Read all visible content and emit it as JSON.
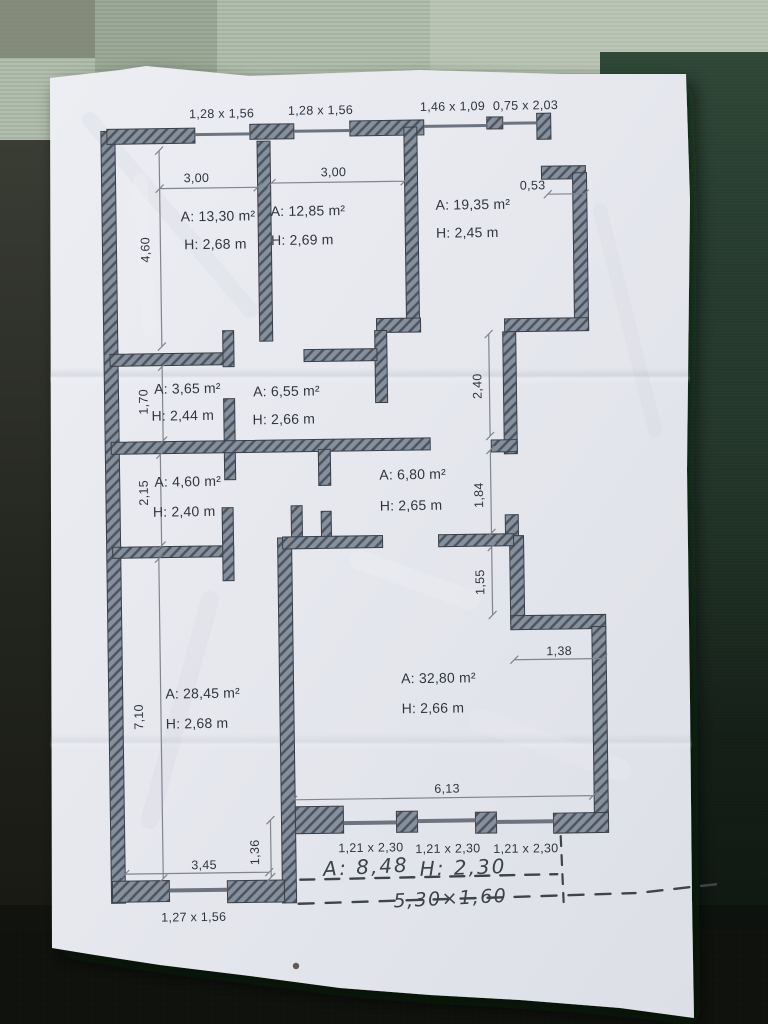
{
  "photo": {
    "subject": "apartment floor plan sketch on crumpled paper",
    "colors": {
      "paper": "#e7e9ee",
      "wall_fill": "#85909c",
      "wall_hatch": "#4d5560",
      "text": "#30353f",
      "dim_line": "#80858e",
      "table_top": "#b3bfae",
      "table_green": "#2c4233",
      "table_dark": "#151713"
    }
  },
  "plan": {
    "top_windows": [
      {
        "label": "1,28 x 1,56"
      },
      {
        "label": "1,28 x 1,56"
      },
      {
        "label": "1,46 x 1,09"
      },
      {
        "label": "0,75 x 2,03"
      }
    ],
    "rooms": [
      {
        "area": "A: 13,30 m²",
        "height": "H: 2,68 m"
      },
      {
        "area": "A: 12,85 m²",
        "height": "H: 2,69 m"
      },
      {
        "area": "A: 19,35 m²",
        "height": "H: 2,45 m"
      },
      {
        "area": "A: 3,65 m²",
        "height": "H: 2,44 m"
      },
      {
        "area": "A: 6,55 m²",
        "height": "H: 2,66 m"
      },
      {
        "area": "A: 4,60 m²",
        "height": "H: 2,40 m"
      },
      {
        "area": "A: 6,80 m²",
        "height": "H: 2,65 m"
      },
      {
        "area": "A: 28,45 m²",
        "height": "H: 2,68 m"
      },
      {
        "area": "A: 32,80 m²",
        "height": "H: 2,66 m"
      }
    ],
    "dims": {
      "room1_width": "3,00",
      "room2_width": "3,00",
      "step_top": "0,53",
      "left_upper": "4,60",
      "left_mid1": "1,70",
      "left_mid2": "2,15",
      "left_lower": "7,10",
      "right_upper": "2,40",
      "right_mid": "1,84",
      "right_lower": "1,55",
      "right_jog": "1,38",
      "bottom_width": "6,13",
      "bottom_left_width": "3,45",
      "bottom_left_offset": "1,36"
    },
    "bottom_windows": [
      {
        "label": "1,21 x 2,30"
      },
      {
        "label": "1,21 x 2,30"
      },
      {
        "label": "1,21 x 2,30"
      }
    ],
    "bottom_left_window": "1,27 x 1,56",
    "handwritten": {
      "area": "A: 8,48",
      "height": "H: 2,30",
      "size": "5,30×1,60"
    }
  }
}
